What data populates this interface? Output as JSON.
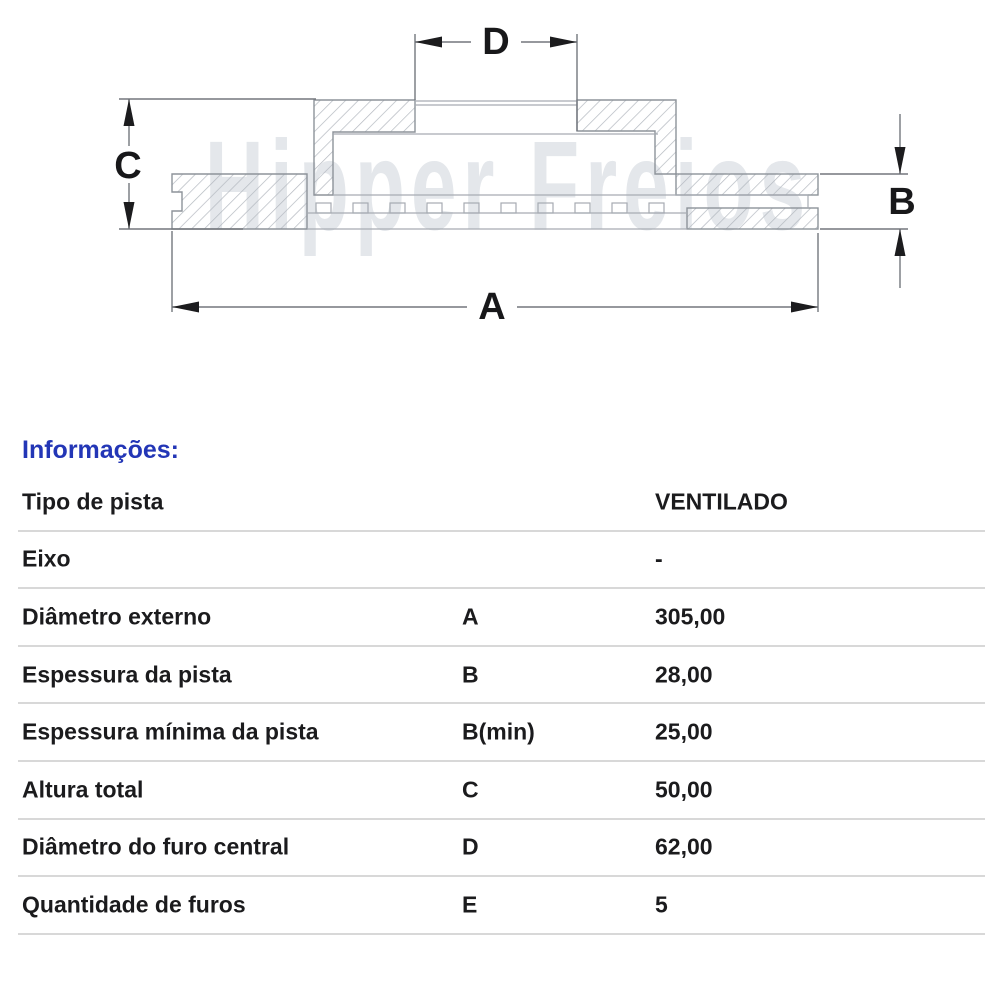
{
  "diagram": {
    "watermark": "Hipper Freios",
    "dim_a": "A",
    "dim_b": "B",
    "dim_c": "C",
    "dim_d": "D"
  },
  "info": {
    "header": "Informações:",
    "rows": [
      {
        "label": "Tipo de pista",
        "letter": "",
        "value": "VENTILADO"
      },
      {
        "label": "Eixo",
        "letter": "",
        "value": "-"
      },
      {
        "label": "Diâmetro externo",
        "letter": "A",
        "value": "305,00"
      },
      {
        "label": "Espessura da pista",
        "letter": "B",
        "value": "28,00"
      },
      {
        "label": "Espessura mínima da pista",
        "letter": "B(min)",
        "value": "25,00"
      },
      {
        "label": "Altura total",
        "letter": "C",
        "value": "50,00"
      },
      {
        "label": "Diâmetro do furo central",
        "letter": "D",
        "value": "62,00"
      },
      {
        "label": "Quantidade de furos",
        "letter": "E",
        "value": "5"
      }
    ],
    "colors": {
      "header_blue": "#2336b6",
      "text": "#1b1b1d",
      "divider": "#d8d8d8"
    }
  }
}
